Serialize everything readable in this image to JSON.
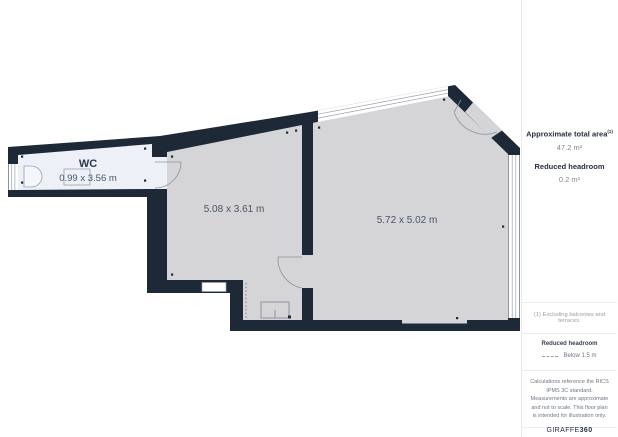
{
  "plan": {
    "rooms": {
      "wc": {
        "name": "WC",
        "dims": "0.99 x 3.56 m"
      },
      "middle": {
        "dims": "5.08 x 3.61 m"
      },
      "main": {
        "dims": "5.72 x 5.02 m"
      }
    },
    "colors": {
      "wall": "#1e2937",
      "room_fill": "#d5d5d7",
      "wc_fill": "#edf1f7",
      "label_text": "#4a5568"
    }
  },
  "sidebar": {
    "total_area_label": "Approximate total area",
    "total_area_sup": "(1)",
    "total_area_value": "47.2 m²",
    "headroom_label": "Reduced headroom",
    "headroom_value": "0.2 m²",
    "footnote": "(1) Excluding balconies and terraces.",
    "legend_title": "Reduced headroom",
    "legend_item": "Below 1.5 m",
    "disclaimer": "Calculations reference the RICS IPMS 3C standard. Measurements are approximate and not to scale. This floor plan is intended for illustration only.",
    "brand_name": "GIRAFFE",
    "brand_suffix": "360"
  }
}
